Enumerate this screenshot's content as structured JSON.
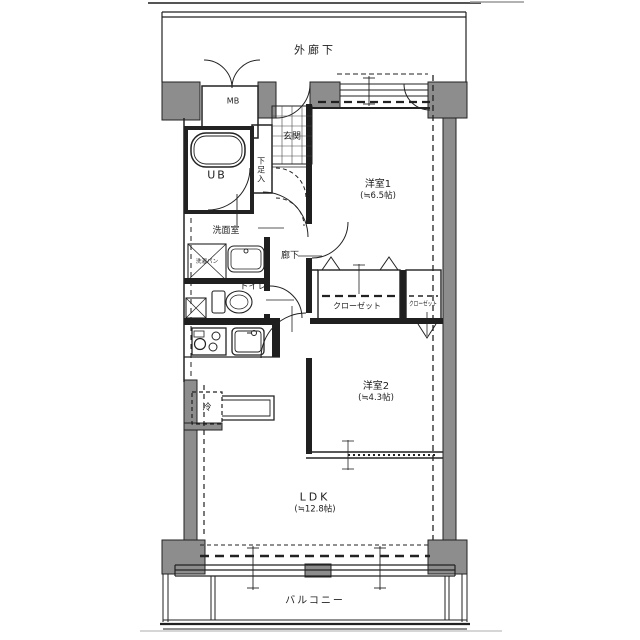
{
  "floor_plan": {
    "type": "japanese-apartment-floorplan",
    "colors": {
      "wall_fill": "#8d8d8d",
      "line": "#222222",
      "background": "#ffffff"
    },
    "labels": {
      "exterior_corridor": "外廊下",
      "meter_box": "MB",
      "entrance": "玄関",
      "shoe_cabinet": "下足入",
      "unit_bath": "UB",
      "washroom": "洗面室",
      "laundry_pan": "洗濯パン",
      "toilet": "トイレ",
      "hallway": "廊下",
      "bedroom1_name": "洋室1",
      "bedroom1_size": "(≒6.5帖)",
      "closet_main": "クローゼット",
      "closet_small": "クローゼット",
      "bedroom2_name": "洋室2",
      "bedroom2_size": "(≒4.3帖)",
      "refrigerator": "冷",
      "ldk_name": "LDK",
      "ldk_size": "(≒12.8帖)",
      "balcony": "バルコニー"
    }
  }
}
